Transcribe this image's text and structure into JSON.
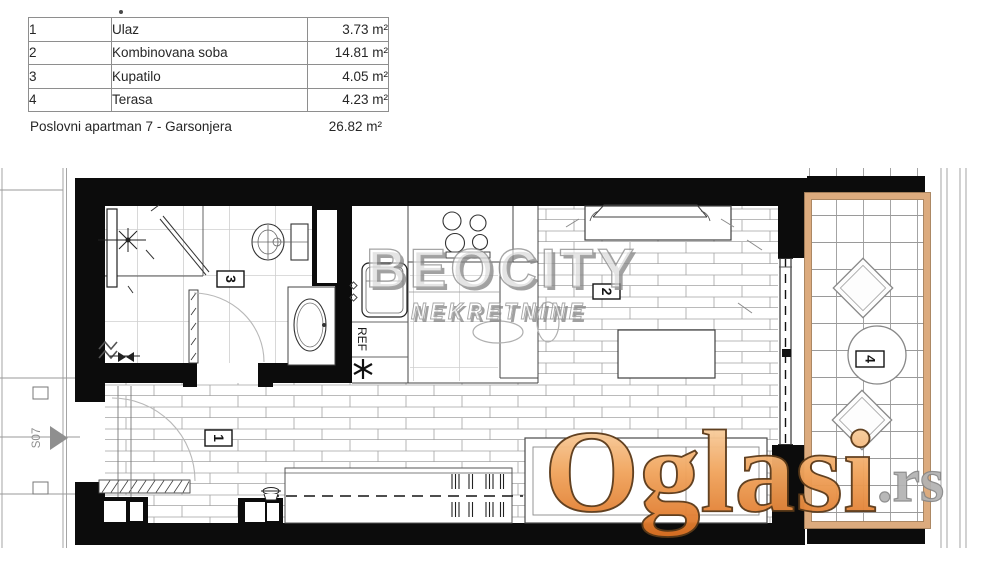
{
  "legend": {
    "rows": [
      {
        "num": "1",
        "name": "Ulaz",
        "area": "3.73 m²"
      },
      {
        "num": "2",
        "name": "Kombinovana soba",
        "area": "14.81 m²"
      },
      {
        "num": "3",
        "name": "Kupatilo",
        "area": "4.05 m²"
      },
      {
        "num": "4",
        "name": "Terasa",
        "area": "4.23 m²"
      }
    ],
    "total_name": "Poslovni apartman 7 - Garsonjera",
    "total_area": "26.82 m²"
  },
  "plan": {
    "room_labels": {
      "r1": "1",
      "r2": "2",
      "r3": "3",
      "r4": "4"
    },
    "ref_label": "REF",
    "door_label": "S07"
  },
  "watermarks": {
    "brand_line1": "BEOCITY",
    "brand_line2": "NEKRETNINE",
    "site_name": "Oglasi",
    "site_tld": ".rs"
  },
  "colors": {
    "wall": "#0c0c0c",
    "terrace_frame": "#dcab7e",
    "watermark_orange": "#f1a55e",
    "watermark_gray": "#8f8f8f"
  }
}
